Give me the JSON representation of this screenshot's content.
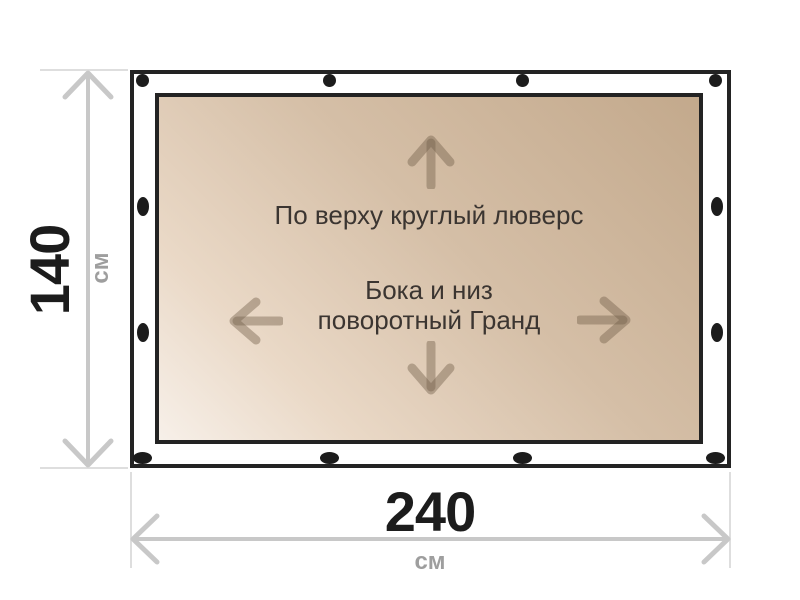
{
  "diagram": {
    "type": "tarpaulin-size-diagram",
    "notes": {
      "top": "По верху круглый люверс",
      "center_line1": "Бока и низ",
      "center_line2": "поворотный Гранд"
    }
  },
  "dimensions": {
    "height": {
      "value": "140",
      "unit": "см"
    },
    "width": {
      "value": "240",
      "unit": "см"
    }
  },
  "grommets": {
    "top_count": 4,
    "bottom_count": 4,
    "left_count": 2,
    "right_count": 2,
    "color": "#1c1c1c"
  },
  "colors": {
    "canvas_gradient_light": "#f7f0e9",
    "canvas_gradient_dark": "#c3a98c",
    "frame_border": "#232323",
    "dimension_line": "#c8c8c8",
    "extension_line": "#dedede",
    "dimension_value_text": "#1c1c1c",
    "dimension_unit_text": "#9e9e9e",
    "note_text": "#3b3531",
    "direction_arrow": "#6f5e48"
  }
}
